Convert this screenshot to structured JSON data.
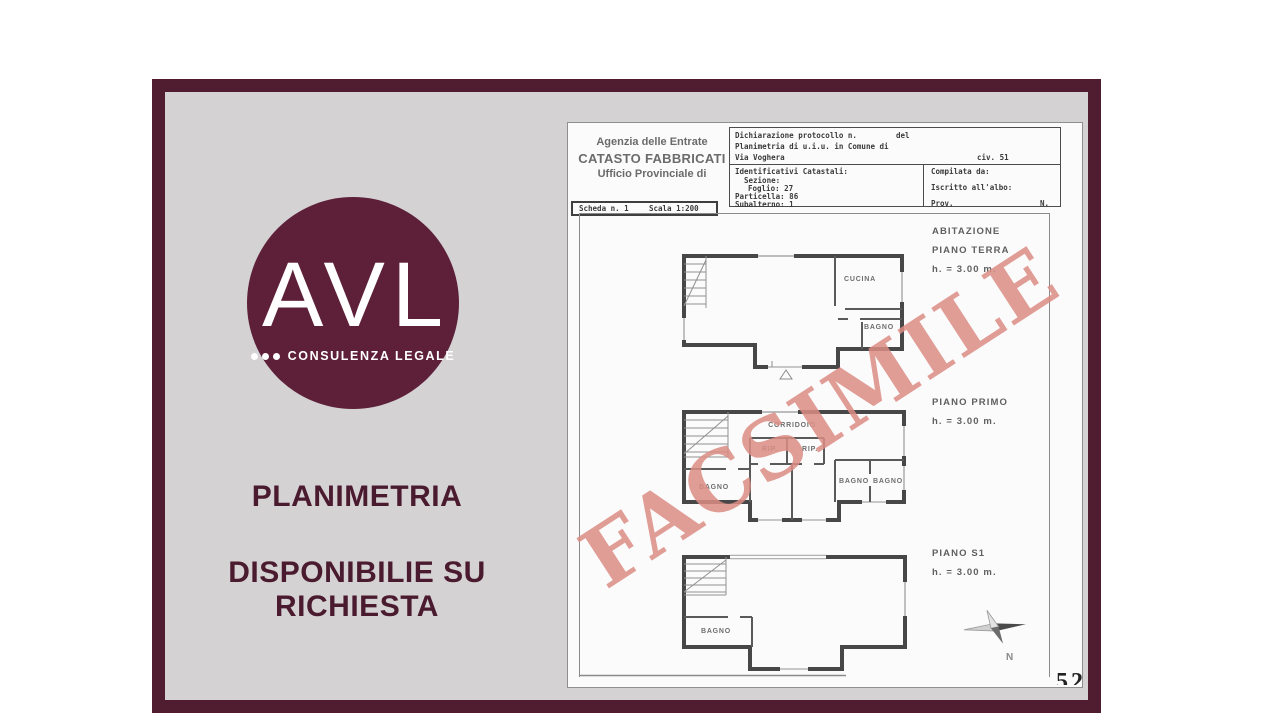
{
  "branding": {
    "logo_text": "AVL",
    "logo_subtitle": "CONSULENZA LEGALE",
    "headline_line1": "PLANIMETRIA",
    "headline_line2": "DISPONIBILIE SU RICHIESTA",
    "accent_color": "#5e2039",
    "frame_color": "#4f1c30"
  },
  "document": {
    "agency": {
      "line1": "Agenzia delle Entrate",
      "line2": "CATASTO FABBRICATI",
      "line3": "Ufficio Provinciale di"
    },
    "protocol": {
      "declaration": "Dichiarazione protocollo n.",
      "del": "del",
      "planimetria": "Planimetria di u.i.u. in Comune di",
      "street": "Via Voghera",
      "civic": "civ. 51"
    },
    "cadastral": {
      "title": "Identificativi Catastali:",
      "sezione": "Sezione:",
      "foglio": "Foglio: 27",
      "particella": "Particella: 86",
      "subalterno": "Subalterno: 1"
    },
    "compiled": {
      "compilata": "Compilata da:",
      "iscritto": "Iscritto all'albo:",
      "prov": "Prov.",
      "n": "N."
    },
    "scheda": {
      "scheda": "Scheda n. 1",
      "scala": "Scala 1:200"
    },
    "watermark": "FACSIMILE",
    "floors": [
      {
        "title": "ABITAZIONE",
        "subtitle": "PIANO TERRA",
        "height": "h. = 3.00 m."
      },
      {
        "title": "PIANO PRIMO",
        "height": "h. = 3.00 m."
      },
      {
        "title": "PIANO S1",
        "height": "h. = 3.00 m."
      }
    ],
    "rooms": {
      "cucina": "CUCINA",
      "bagno_terra": "BAGNO",
      "corridoio": "CORRIDOIO",
      "rip_1": "RIP.",
      "rip_2": "RIP.",
      "bagno_primo_sx": "BAGNO",
      "bagno_primo_1": "BAGNO",
      "bagno_primo_2": "BAGNO",
      "bagno_s1": "BAGNO"
    },
    "compass_label": "N",
    "corner_marks": "52"
  }
}
